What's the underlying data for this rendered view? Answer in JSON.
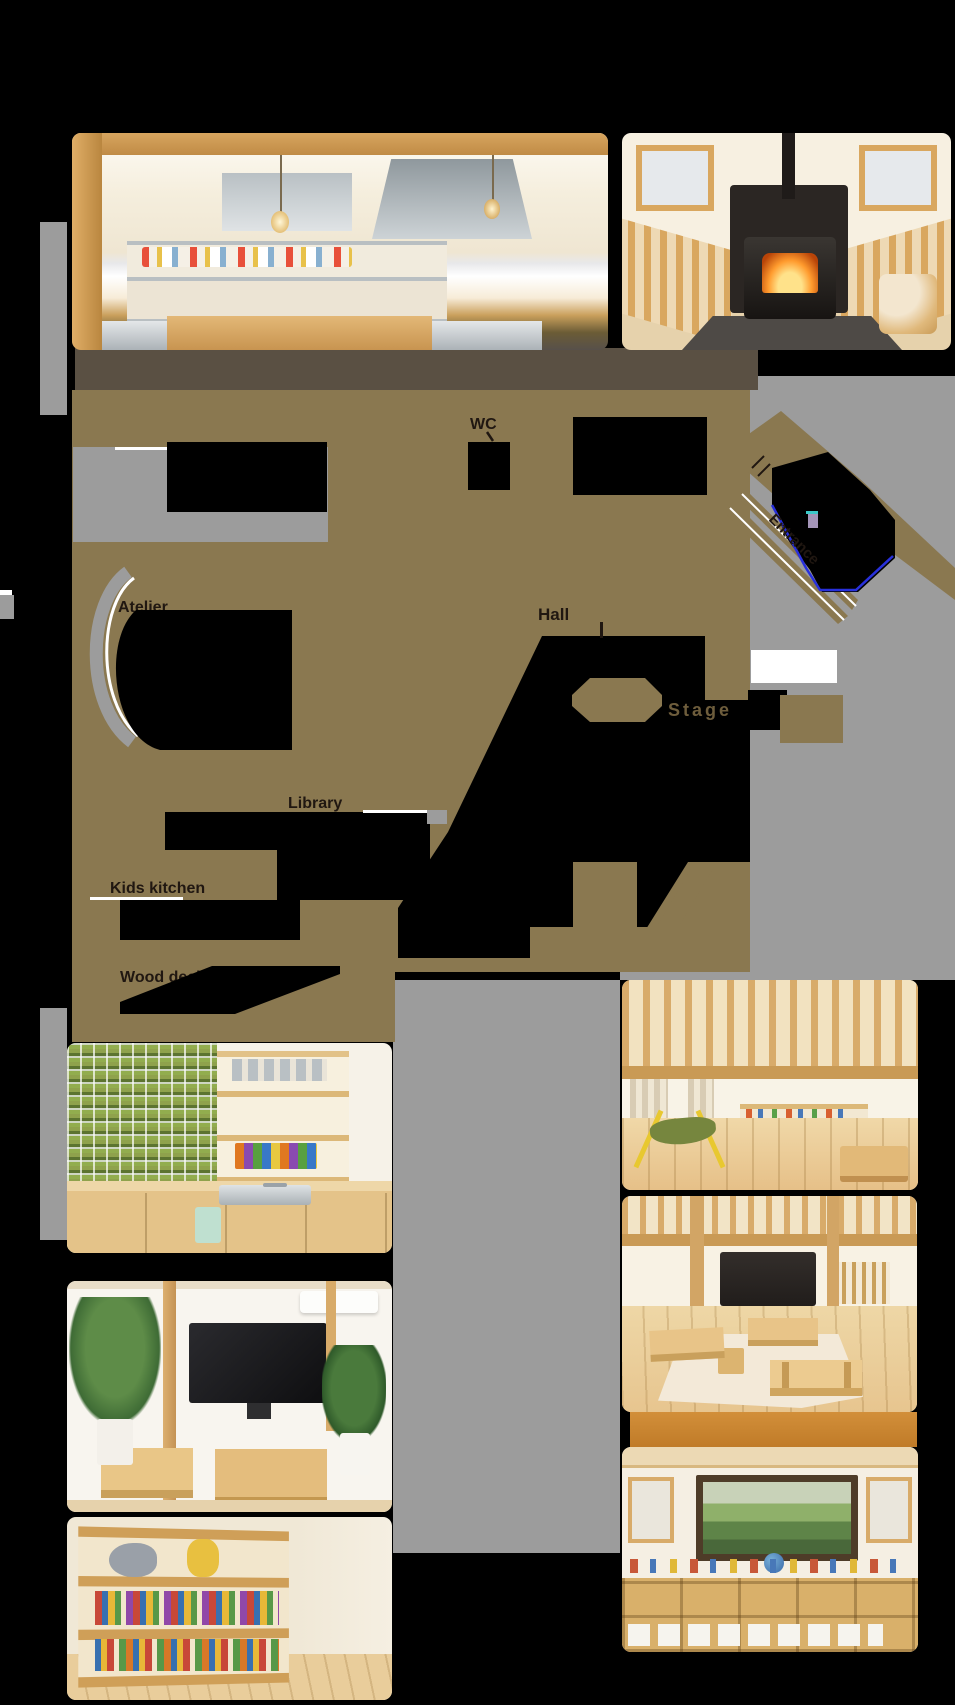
{
  "floor_plan": {
    "labels": {
      "wc": "WC",
      "hall": "Hall",
      "stage": "Stage",
      "library": "Library",
      "kids_kitchen": "Kids kitchen",
      "wood_deck": "Wood deck",
      "atelier": "Atelier",
      "entrance": "Entrance"
    },
    "colors": {
      "plan_fill": "#8a7850",
      "top_wall": "#5a5043",
      "shadow_gray": "#9c9c9c",
      "room_cutout": "#000000",
      "stage_white": "#ffffff",
      "label_ink": "#201711",
      "stage_ink": "#6e5d3c",
      "accent_blue": "#2830dc",
      "accent_purple": "#a495b8",
      "accent_cyan": "#3cc8c8",
      "divider_orange": "#c8842f"
    }
  },
  "photos": [
    {
      "name": "main-kitchen-photo"
    },
    {
      "name": "wood-stove-photo"
    },
    {
      "name": "kids-kitchen-photo"
    },
    {
      "name": "hammock-playroom-photo"
    },
    {
      "name": "tables-classroom-photo"
    },
    {
      "name": "tv-room-photo"
    },
    {
      "name": "picture-book-shelf-photo"
    },
    {
      "name": "toy-shelves-photo"
    }
  ]
}
